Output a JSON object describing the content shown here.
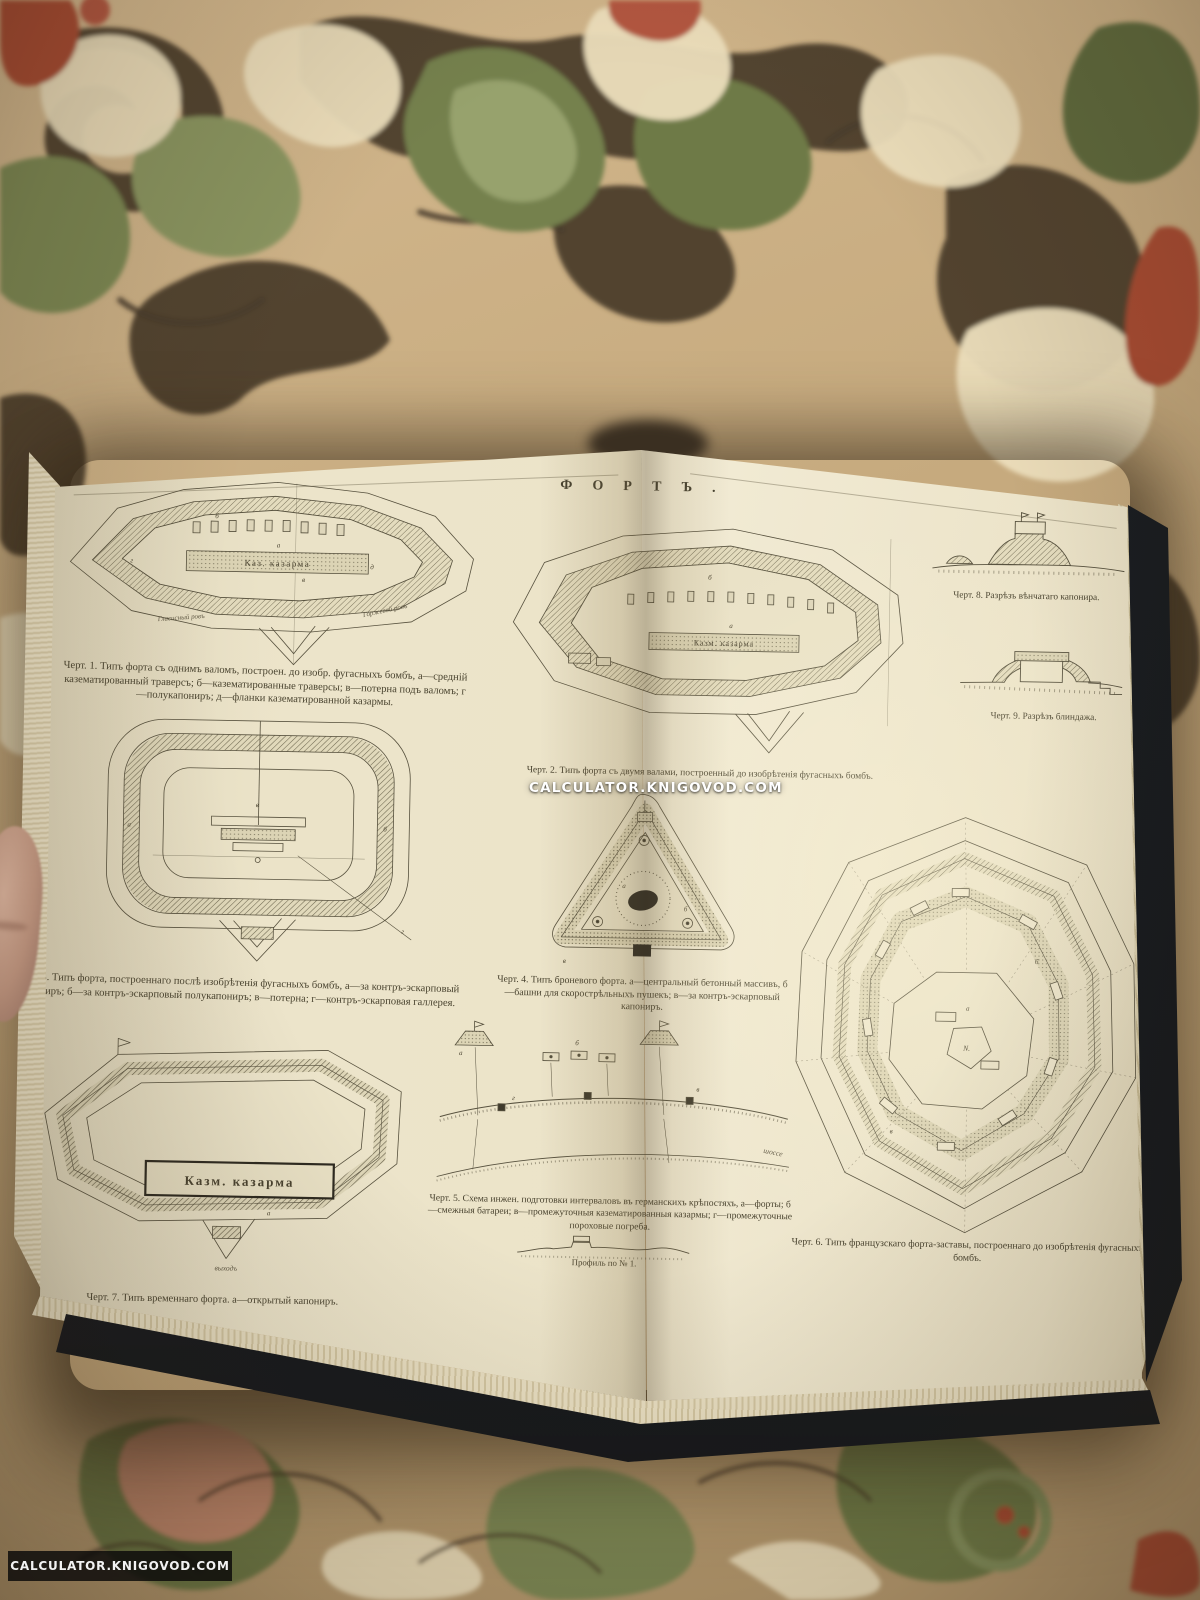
{
  "watermarks": {
    "center": "CALCULATOR.KNIGOVOD.COM",
    "bottom": "CALCULATOR.KNIGOVOD.COM"
  },
  "plate": {
    "title": "ФОРТЪ.",
    "imprint": "рокгаузъ-Ефронъ, „Энцикл. Слов.“.",
    "captions": {
      "fig1": "Черт. 1. Типъ форта съ однимъ валомъ, построен. до изобр. фугасныхъ бомбъ, а—средній казематированный траверсъ; б—казематированные траверсы; в—потерна подъ валомъ; г—полукапониръ; д—фланки казематированной казармы.",
      "fig2": "Черт. 2. Типъ форта съ двумя валами, построенный до изобрѣтенія фугасныхъ бомбъ.",
      "fig3": "Черт. 3. Типъ форта, построеннаго послѣ изобрѣтенія фугасныхъ бомбъ, а—за контръ-эскарповый капониръ; б—за контръ-эскарповый полукапониръ; в—потерна; г—контръ-эскарповая галлерея.",
      "fig4": "Черт. 4. Типъ броневого форта. а—центральный бетонный массивъ, б—башни для скорострѣльныхъ пушекъ; в—за контръ-эскарповый капониръ.",
      "fig5": "Черт. 5. Схема инжен. подготовки интерваловъ въ германскихъ крѣпостяхъ, а—форты; б—смежныя батареи; в—промежуточныя казематированныя казармы; г—промежуточные пороховые погреба.",
      "fig6": "Черт. 6. Типъ французскаго форта-заставы, построеннаго до изобрѣтенія фугасныхъ бомбъ.",
      "fig7": "Черт. 7. Типъ временнаго форта. а—открытый капониръ.",
      "fig8": "Черт. 8. Разрѣзъ вѣнчатаго капонира.",
      "fig9": "Черт. 9. Разрѣзъ блиндажа."
    },
    "labels": {
      "fig1_barracks": "Каз. казарма",
      "fig1_glacis_ditch": "Гласисный ровъ",
      "fig1_gorge_ditch": "Горжевой ровъ",
      "fig2_barracks": "Казм. казарма",
      "fig5_road": "шоссе",
      "fig5_profile": "Профиль по № 1.",
      "fig7_barracks": "Казм. казарма",
      "fig7_exit": "выходъ"
    },
    "markers": {
      "a": "а",
      "b": "б",
      "v": "в",
      "g": "г",
      "d": "д",
      "n": "N."
    }
  }
}
